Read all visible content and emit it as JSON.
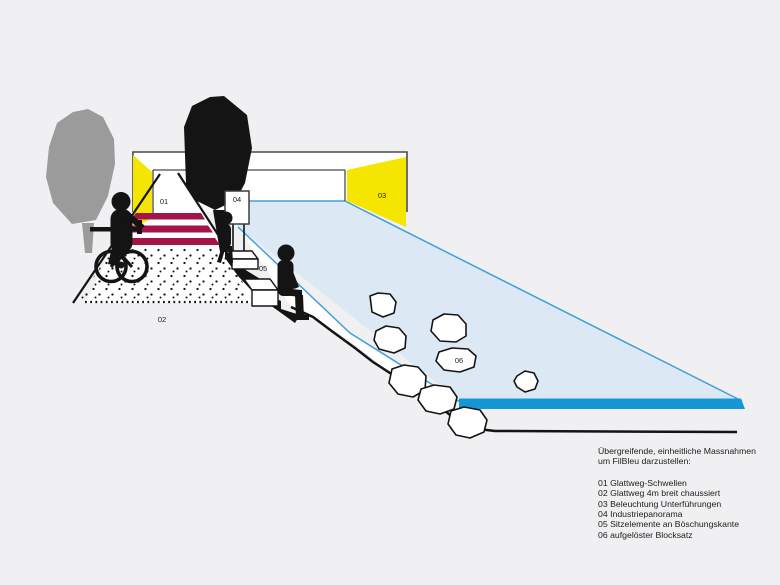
{
  "colors": {
    "background": "#f0f0f2",
    "yellow": "#f4e600",
    "crimson": "#a31548",
    "water_fill": "#dce9f4",
    "water_stroke": "#41a0d8",
    "river_band": "#1497d4",
    "tree_gray": "#9b9b9b",
    "ink": "#141414"
  },
  "markers": {
    "m01": "01",
    "m02": "02",
    "m03": "03",
    "m04": "04",
    "m05": "05",
    "m06": "06"
  },
  "legend": {
    "intro": [
      "Übergreifende, einheitliche Massnahmen",
      "um FilBleu darzustellen:"
    ],
    "items": [
      "01 Glattweg-Schwellen",
      "02 Glattweg 4m breit chaussiert",
      "03 Beleuchtung Unterführungen",
      "04 Industriepanorama",
      "05 Sitzelemente an Böschungskante",
      "06 aufgelöster Blocksatz"
    ]
  }
}
